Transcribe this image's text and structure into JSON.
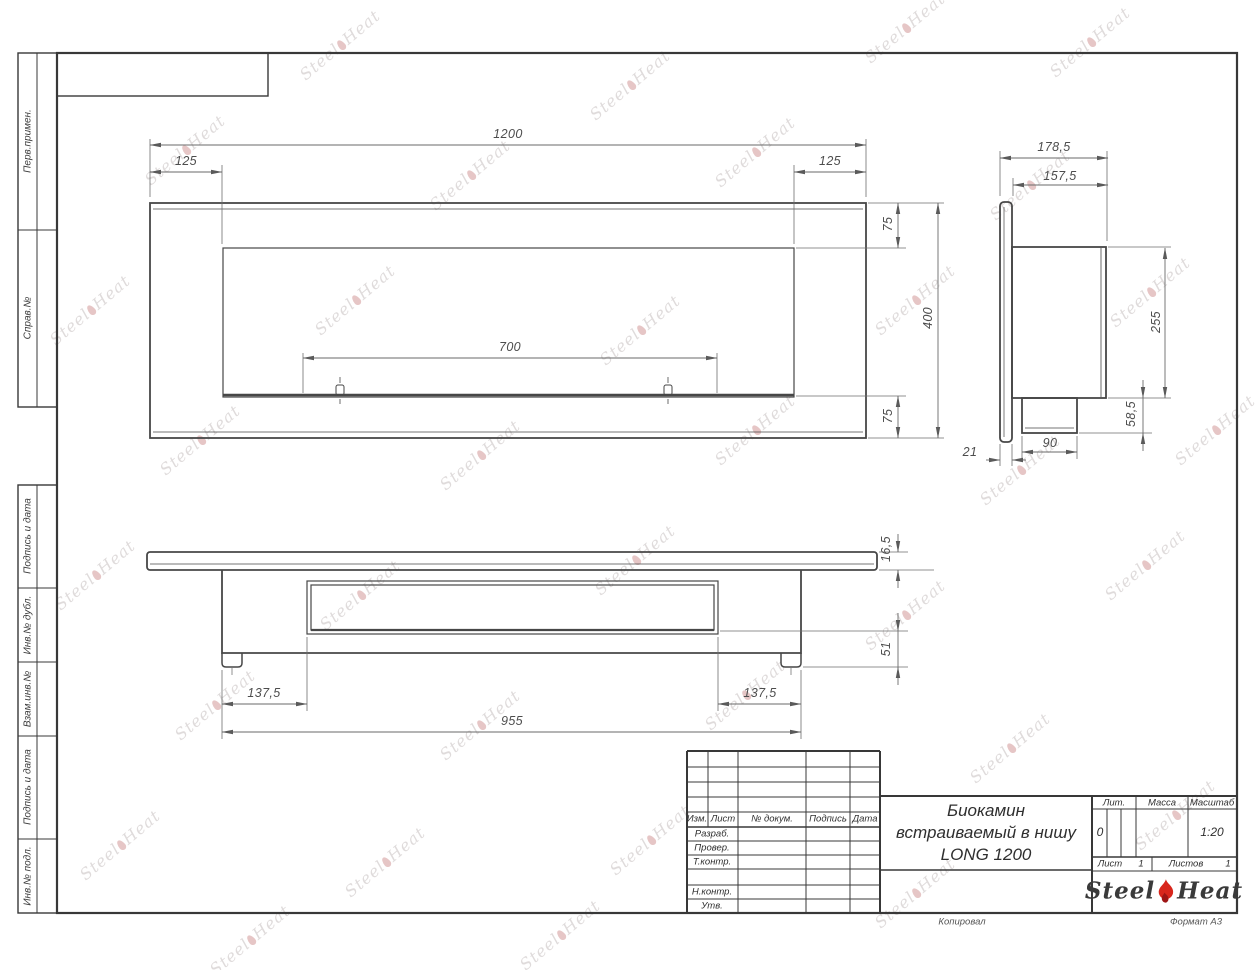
{
  "frame_labels": [
    "Перв.примен.",
    "Справ.№",
    "Подпись и дата",
    "Инв.№ дубл.",
    "Взам.инв.№",
    "Подпись и дата",
    "Инв.№ подл."
  ],
  "dims": {
    "front_total": "1200",
    "front_left": "125",
    "front_right": "125",
    "front_top": "75",
    "front_height": "400",
    "front_bottom": "75",
    "front_opening": "700",
    "side_depth_total": "178,5",
    "side_depth_body": "157,5",
    "side_height": "255",
    "side_ledge_h": "58,5",
    "side_ledge_w": "90",
    "side_flange": "21",
    "bottom_flange": "16,5",
    "bottom_foot": "51",
    "bottom_left": "137,5",
    "bottom_right": "137,5",
    "bottom_length": "955"
  },
  "title_block": {
    "rev_col1": "Изм.",
    "rev_col2": "Лист",
    "rev_col3": "№ докум.",
    "rev_col4": "Подпись",
    "rev_col5": "Дата",
    "role1": "Разраб.",
    "role2": "Провер.",
    "role3": "Т.контр.",
    "role4": "Н.контр.",
    "role5": "Утв.",
    "title_line1": "Биокамин",
    "title_line2": "встраиваемый в нишу",
    "title_line3": "LONG 1200",
    "lit_label": "Лит.",
    "lit_value": "0",
    "mass_label": "Масса",
    "mass_value": "",
    "scale_label": "Масштаб",
    "scale_value": "1:20",
    "sheet_label": "Лист",
    "sheet_value": "1",
    "sheets_label": "Листов",
    "sheets_value": "1",
    "logo_word1": "Steel",
    "logo_word2": "Heat"
  },
  "footer": {
    "copied_note": "Копировал",
    "format_note": "Формат А3"
  },
  "watermark": {
    "word1": "Steel",
    "word2": "Heat"
  },
  "colors": {
    "line": "#454545",
    "dim_line": "#6e6e6e",
    "flame_red": "#d8261c"
  }
}
